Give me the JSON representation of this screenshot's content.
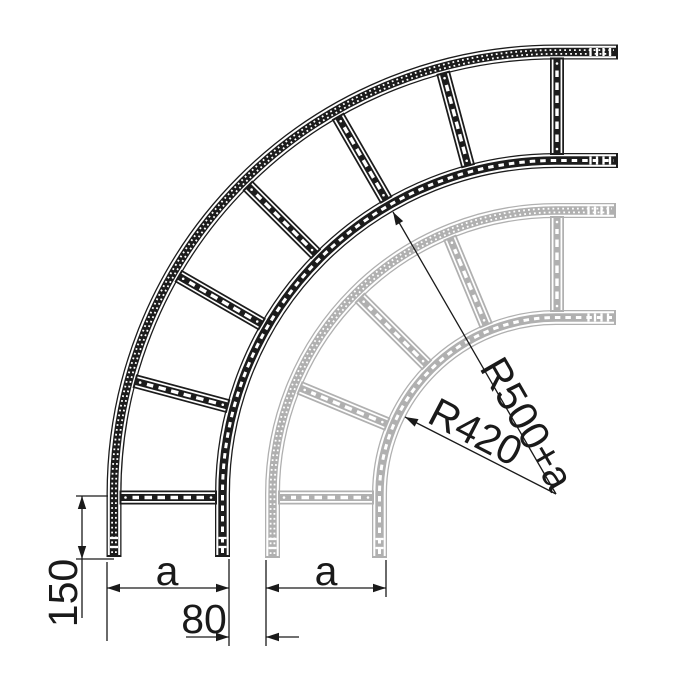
{
  "dimensions": {
    "leg_length": "150",
    "front_width": "a",
    "ladder_gap": "80",
    "back_width": "a",
    "front_radius": "R500+a",
    "back_radius": "R420"
  },
  "colors": {
    "front_ladder": "#1c1c1c",
    "back_ladder": "#b0b0b0",
    "dimension_lines": "#1a1a1a",
    "background": "#ffffff"
  }
}
